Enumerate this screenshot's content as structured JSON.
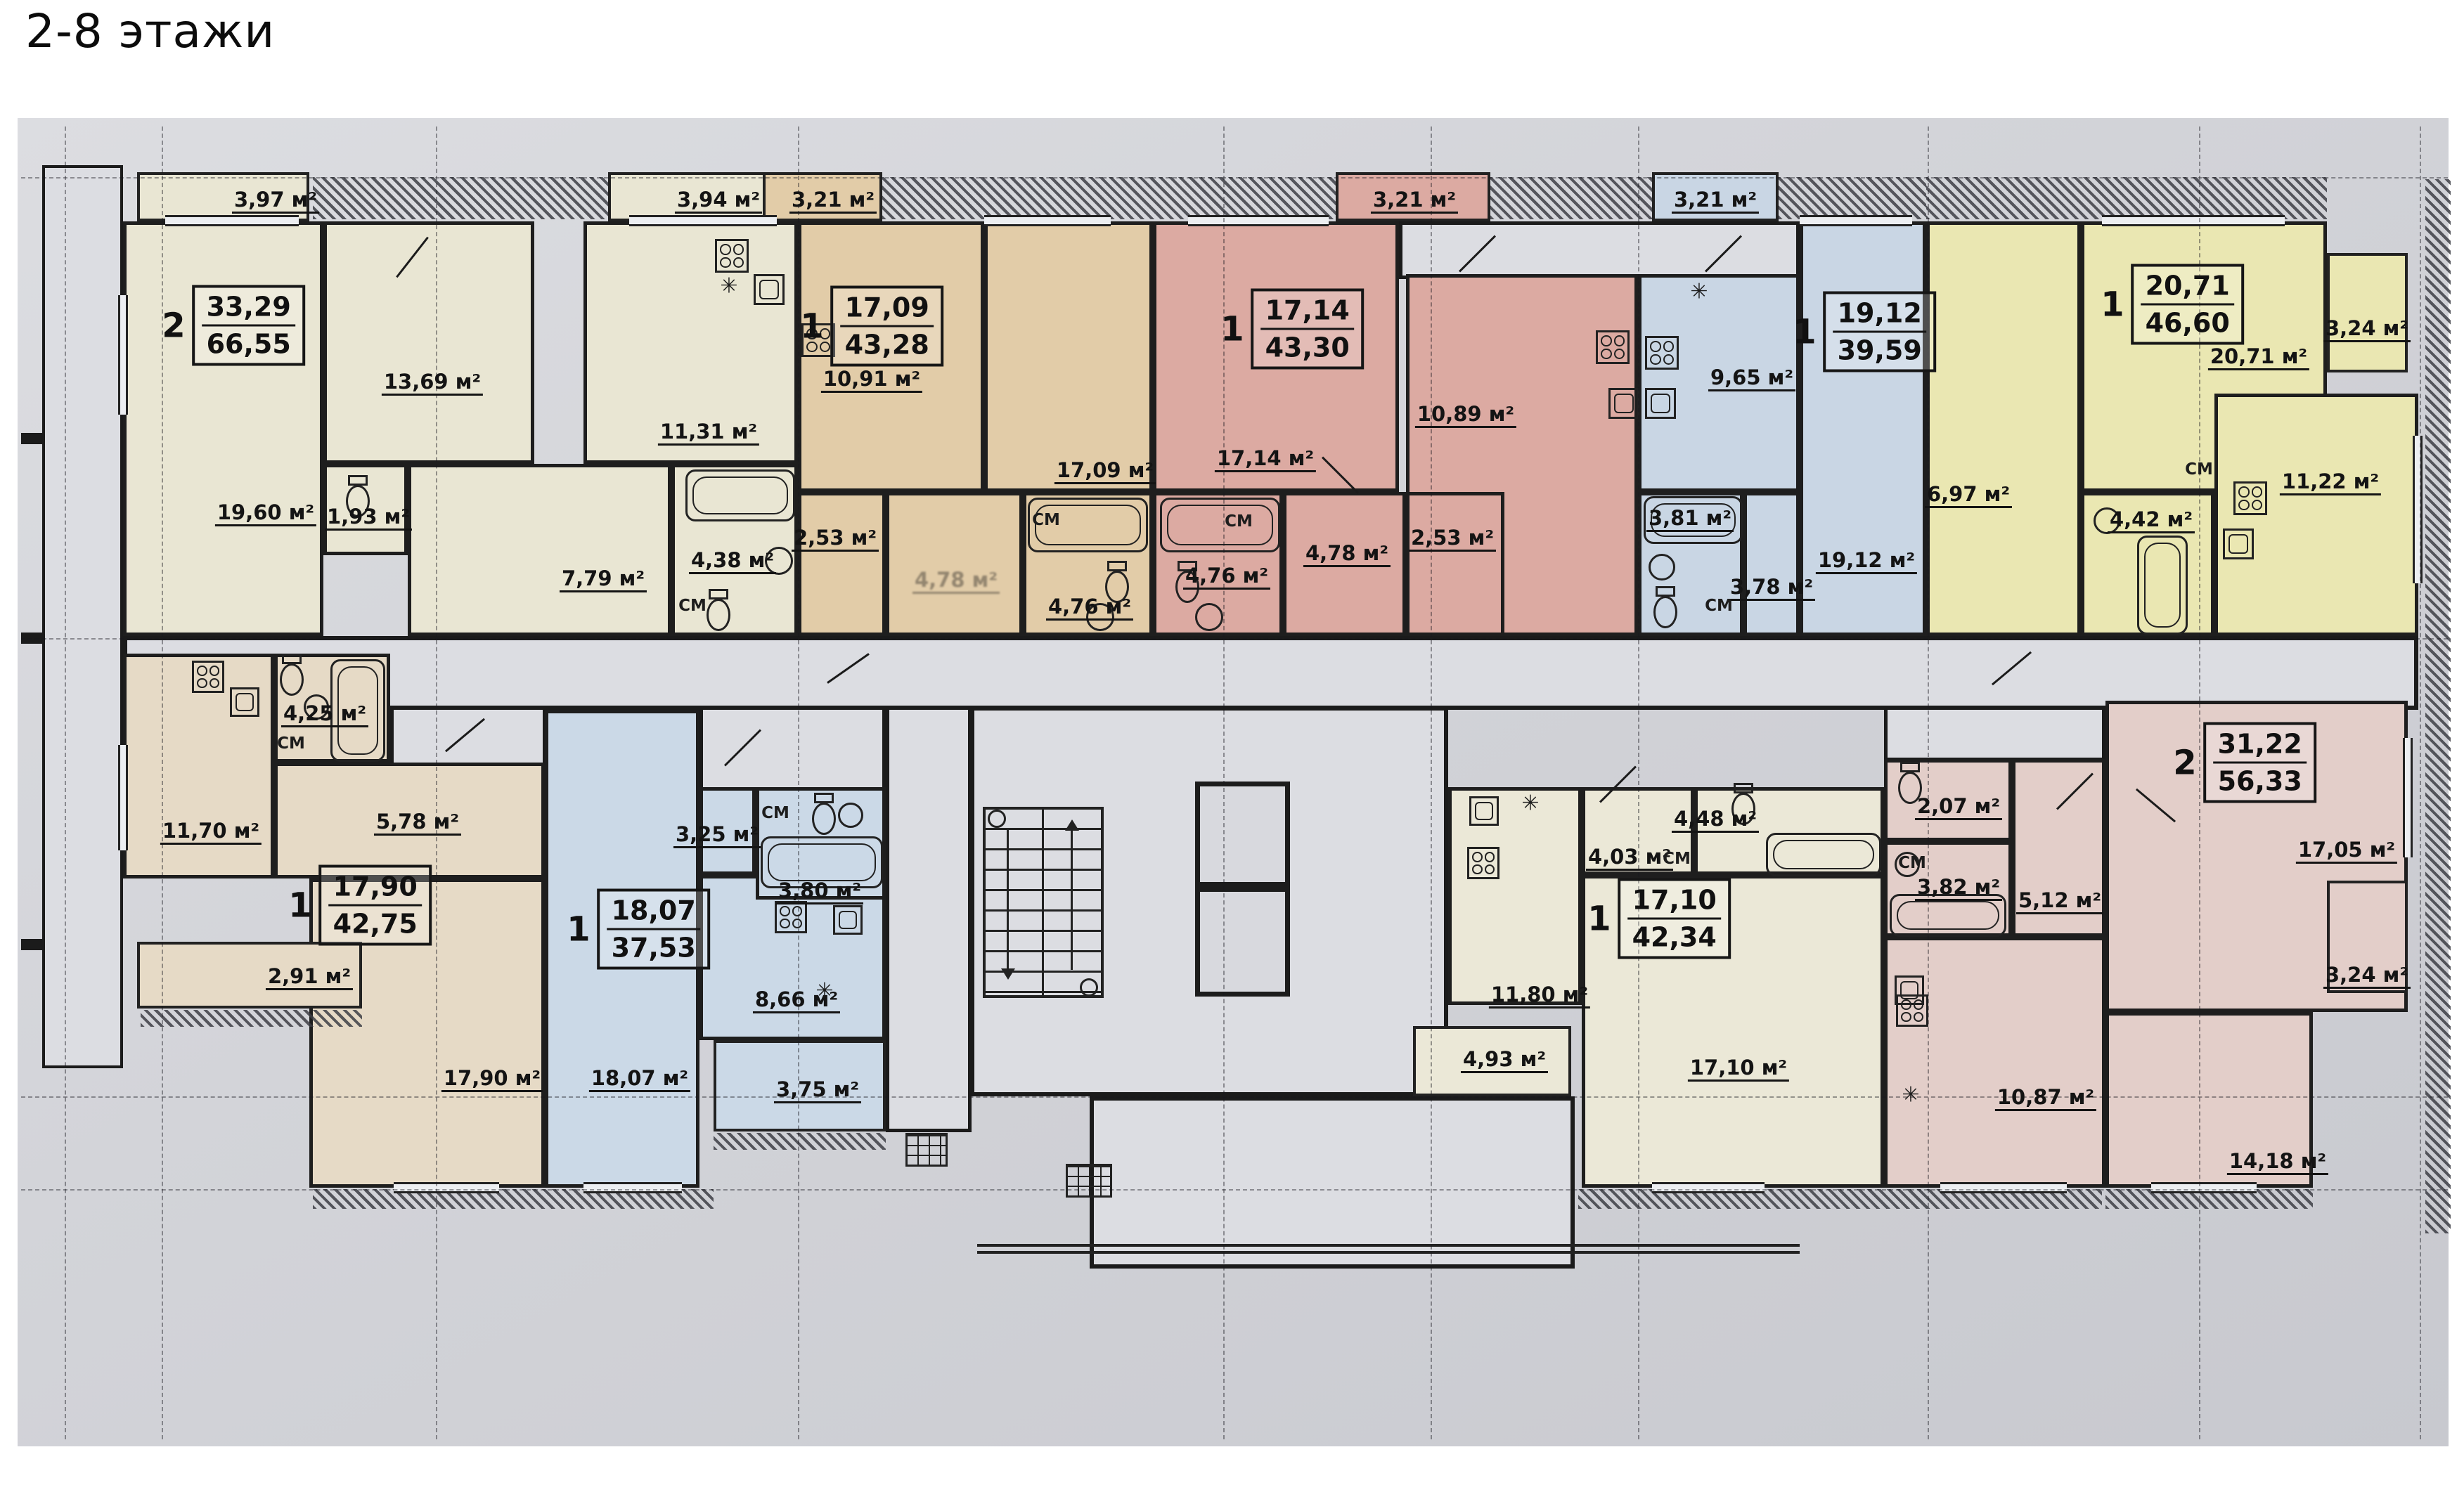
{
  "title": "2-8 этажи",
  "area_unit": "м²",
  "closet_label": "СМ",
  "vent_symbol": "✳",
  "apartments": [
    {
      "id": "apt-2k-6655",
      "rooms_count": "2",
      "living_area": "33,29",
      "total_area": "66,55",
      "rooms": {
        "living": {
          "label": "19,60 м²"
        },
        "bedroom": {
          "label": "13,69 м²"
        },
        "kitchen": {
          "label": "11,31 м²"
        },
        "hall": {
          "label": "7,79 м²"
        },
        "bathroom": {
          "label": "4,38 м²"
        },
        "wc": {
          "label": "1,93 м²"
        },
        "balcony": {
          "label": "3,97 м²"
        },
        "balcony2": {
          "label": "3,94 м²"
        }
      }
    },
    {
      "id": "apt-1k-4328",
      "rooms_count": "1",
      "living_area": "17,09",
      "total_area": "43,28",
      "rooms": {
        "kitchen": {
          "label": "10,91 м²"
        },
        "living": {
          "label": "17,09 м²"
        },
        "closet": {
          "label": "2,53 м²"
        },
        "hall": {
          "label": "4,78 м²"
        },
        "bathroom": {
          "label": "4,76 м²"
        },
        "balcony": {
          "label": "3,21 м²"
        }
      }
    },
    {
      "id": "apt-1k-4330",
      "rooms_count": "1",
      "living_area": "17,14",
      "total_area": "43,30",
      "rooms": {
        "living": {
          "label": "17,14 м²"
        },
        "kitchen": {
          "label": "10,89 м²"
        },
        "bathroom": {
          "label": "4,76 м²"
        },
        "hall": {
          "label": "4,78 м²"
        },
        "closet": {
          "label": "2,53 м²"
        },
        "balcony": {
          "label": "3,21 м²"
        }
      }
    },
    {
      "id": "apt-1k-3959",
      "rooms_count": "1",
      "living_area": "19,12",
      "total_area": "39,59",
      "rooms": {
        "kitchen": {
          "label": "9,65 м²"
        },
        "living": {
          "label": "19,12 м²"
        },
        "bathroom": {
          "label": "3,81 м²"
        },
        "hall": {
          "label": "3,78 м²"
        },
        "balcony": {
          "label": "3,21 м²"
        }
      }
    },
    {
      "id": "apt-1k-4660",
      "rooms_count": "1",
      "living_area": "20,71",
      "total_area": "46,60",
      "rooms": {
        "living": {
          "label": "20,71 м²"
        },
        "kitchen": {
          "label": "11,22 м²"
        },
        "hall": {
          "label": "6,97 м²"
        },
        "bathroom": {
          "label": "4,42 м²"
        },
        "balcony": {
          "label": "3,24 м²"
        }
      }
    },
    {
      "id": "apt-2k-5633",
      "rooms_count": "2",
      "living_area": "31,22",
      "total_area": "56,33",
      "rooms": {
        "living": {
          "label": "17,05 м²"
        },
        "bedroom": {
          "label": "14,18 м²"
        },
        "kitchen": {
          "label": "10,87 м²"
        },
        "hall": {
          "label": "5,12 м²"
        },
        "bathroom": {
          "label": "3,82 м²"
        },
        "wc": {
          "label": "2,07 м²"
        },
        "balcony": {
          "label": "3,24 м²"
        }
      }
    },
    {
      "id": "apt-1k-4275",
      "rooms_count": "1",
      "living_area": "17,90",
      "total_area": "42,75",
      "rooms": {
        "living": {
          "label": "17,90 м²"
        },
        "kitchen": {
          "label": "11,70 м²"
        },
        "hall": {
          "label": "5,78 м²"
        },
        "bathroom": {
          "label": "4,25 м²"
        },
        "balcony": {
          "label": "2,91 м²"
        }
      }
    },
    {
      "id": "apt-1k-3753",
      "rooms_count": "1",
      "living_area": "18,07",
      "total_area": "37,53",
      "rooms": {
        "living": {
          "label": "18,07 м²"
        },
        "kitchen": {
          "label": "8,66 м²"
        },
        "hall": {
          "label": "3,25 м²"
        },
        "bathroom": {
          "label": "3,80 м²"
        },
        "balcony": {
          "label": "3,75 м²"
        }
      }
    },
    {
      "id": "apt-1k-4234",
      "rooms_count": "1",
      "living_area": "17,10",
      "total_area": "42,34",
      "rooms": {
        "living": {
          "label": "17,10 м²"
        },
        "kitchen": {
          "label": "11,80 м²"
        },
        "hall": {
          "label": "4,03 м²"
        },
        "bathroom": {
          "label": "4,48 м²"
        },
        "balcony": {
          "label": "4,93 м²"
        }
      }
    }
  ]
}
